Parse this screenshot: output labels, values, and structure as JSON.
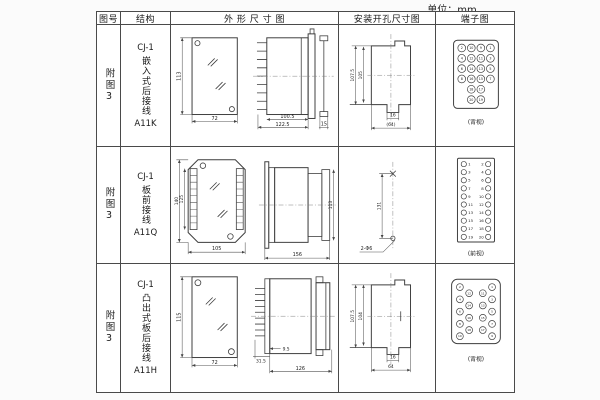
{
  "unit_label": "单位：mm",
  "table": {
    "headers": [
      "图号",
      "结构",
      "外 形 尺 寸 图",
      "安装开孔尺寸图",
      "端子图"
    ]
  },
  "rows": [
    {
      "fig": "附图3",
      "structure": {
        "model": "CJ-1",
        "type": "嵌入式后接线",
        "code": "A11K"
      },
      "outline": {
        "h": "113",
        "w": "72",
        "d1": "100.5",
        "d2": "122.5",
        "f": "15"
      },
      "install": {
        "h1": "107.5",
        "h2": "105",
        "t": "16",
        "w": "(64)"
      },
      "terminal": {
        "caption": "(背视)",
        "circles": [
          {
            "x": 0,
            "y": 0,
            "n": "2"
          },
          {
            "x": 1,
            "y": 0,
            "n": "10"
          },
          {
            "x": 2,
            "y": 0,
            "n": "9"
          },
          {
            "x": 3,
            "y": 0,
            "n": "1"
          },
          {
            "x": 0,
            "y": 1,
            "n": "4"
          },
          {
            "x": 1,
            "y": 1,
            "n": "12"
          },
          {
            "x": 2,
            "y": 1,
            "n": "11"
          },
          {
            "x": 3,
            "y": 1,
            "n": "3"
          },
          {
            "x": 0,
            "y": 2,
            "n": "6"
          },
          {
            "x": 1,
            "y": 2,
            "n": "14"
          },
          {
            "x": 2,
            "y": 2,
            "n": "13"
          },
          {
            "x": 3,
            "y": 2,
            "n": "5"
          },
          {
            "x": 0,
            "y": 3,
            "n": "8"
          },
          {
            "x": 1,
            "y": 3,
            "n": "16"
          },
          {
            "x": 2,
            "y": 3,
            "n": "15"
          },
          {
            "x": 3,
            "y": 3,
            "n": "7"
          },
          {
            "x": 1,
            "y": 4,
            "n": "18"
          },
          {
            "x": 2,
            "y": 4,
            "n": "17"
          },
          {
            "x": 1,
            "y": 5,
            "n": "20"
          },
          {
            "x": 2,
            "y": 5,
            "n": "19"
          }
        ]
      }
    },
    {
      "fig": "附图3",
      "structure": {
        "model": "CJ-1",
        "type": "板前接线",
        "code": "A11Q"
      },
      "outline": {
        "h1": "140",
        "h2": "125",
        "w": "105",
        "d": "156",
        "sh": "113"
      },
      "install": {
        "s": "131",
        "holes": "2-Φ6"
      },
      "terminal": {
        "caption": "(前视)",
        "circles": [
          {
            "x": 0,
            "y": 0,
            "n": "1",
            "to": 4.5
          },
          {
            "x": 1,
            "y": 0,
            "n": "2",
            "to": -4.5
          },
          {
            "x": 0,
            "y": 1,
            "n": "3",
            "to": 4.5
          },
          {
            "x": 1,
            "y": 1,
            "n": "4",
            "to": -4.5
          },
          {
            "x": 0,
            "y": 2,
            "n": "5",
            "to": 4.5
          },
          {
            "x": 1,
            "y": 2,
            "n": "6",
            "to": -4.5
          },
          {
            "x": 0,
            "y": 3,
            "n": "7",
            "to": 4.5
          },
          {
            "x": 1,
            "y": 3,
            "n": "8",
            "to": -4.5
          },
          {
            "x": 0,
            "y": 4,
            "n": "9",
            "to": 4.5
          },
          {
            "x": 1,
            "y": 4,
            "n": "10",
            "to": -4.5
          },
          {
            "x": 0,
            "y": 5,
            "n": "11",
            "to": 4.5
          },
          {
            "x": 1,
            "y": 5,
            "n": "12",
            "to": -4.5
          },
          {
            "x": 0,
            "y": 6,
            "n": "13",
            "to": 4.5
          },
          {
            "x": 1,
            "y": 6,
            "n": "14",
            "to": -4.5
          },
          {
            "x": 0,
            "y": 7,
            "n": "15",
            "to": 4.5
          },
          {
            "x": 1,
            "y": 7,
            "n": "16",
            "to": -4.5
          },
          {
            "x": 0,
            "y": 8,
            "n": "17",
            "to": 4.5
          },
          {
            "x": 1,
            "y": 8,
            "n": "18",
            "to": -4.5
          },
          {
            "x": 0,
            "y": 9,
            "n": "19",
            "to": 4.5
          },
          {
            "x": 1,
            "y": 9,
            "n": "20",
            "to": -4.5
          }
        ]
      }
    },
    {
      "fig": "附图3",
      "structure": {
        "model": "CJ-1",
        "type": "凸出式板后接线",
        "code": "A11H"
      },
      "outline": {
        "h": "115",
        "w": "72",
        "p": "9.5",
        "f": "31.5",
        "d": "126"
      },
      "install": {
        "h1": "107.5",
        "h2": "104",
        "t": "16",
        "w": "64"
      },
      "terminal": {
        "caption": "(背视)",
        "circles": [
          {
            "x": 0,
            "y": 0,
            "n": "2"
          },
          {
            "x": 0,
            "y": 1,
            "n": "4"
          },
          {
            "x": 0,
            "y": 2,
            "n": "6"
          },
          {
            "x": 0,
            "y": 3,
            "n": "8"
          },
          {
            "x": 0,
            "y": 4,
            "n": "10"
          },
          {
            "x": 1,
            "y": 0.5,
            "n": "12"
          },
          {
            "x": 1,
            "y": 1.5,
            "n": "14"
          },
          {
            "x": 1,
            "y": 2.5,
            "n": "16"
          },
          {
            "x": 1,
            "y": 3.5,
            "n": "18"
          },
          {
            "x": 2,
            "y": 0.5,
            "n": "11"
          },
          {
            "x": 2,
            "y": 1.5,
            "n": "13"
          },
          {
            "x": 2,
            "y": 2.5,
            "n": "15"
          },
          {
            "x": 2,
            "y": 3.5,
            "n": "17"
          },
          {
            "x": 3,
            "y": 0,
            "n": "1"
          },
          {
            "x": 3,
            "y": 1,
            "n": "3"
          },
          {
            "x": 3,
            "y": 2,
            "n": "5"
          },
          {
            "x": 3,
            "y": 3,
            "n": "7"
          },
          {
            "x": 3,
            "y": 4,
            "n": "9"
          }
        ]
      }
    }
  ]
}
